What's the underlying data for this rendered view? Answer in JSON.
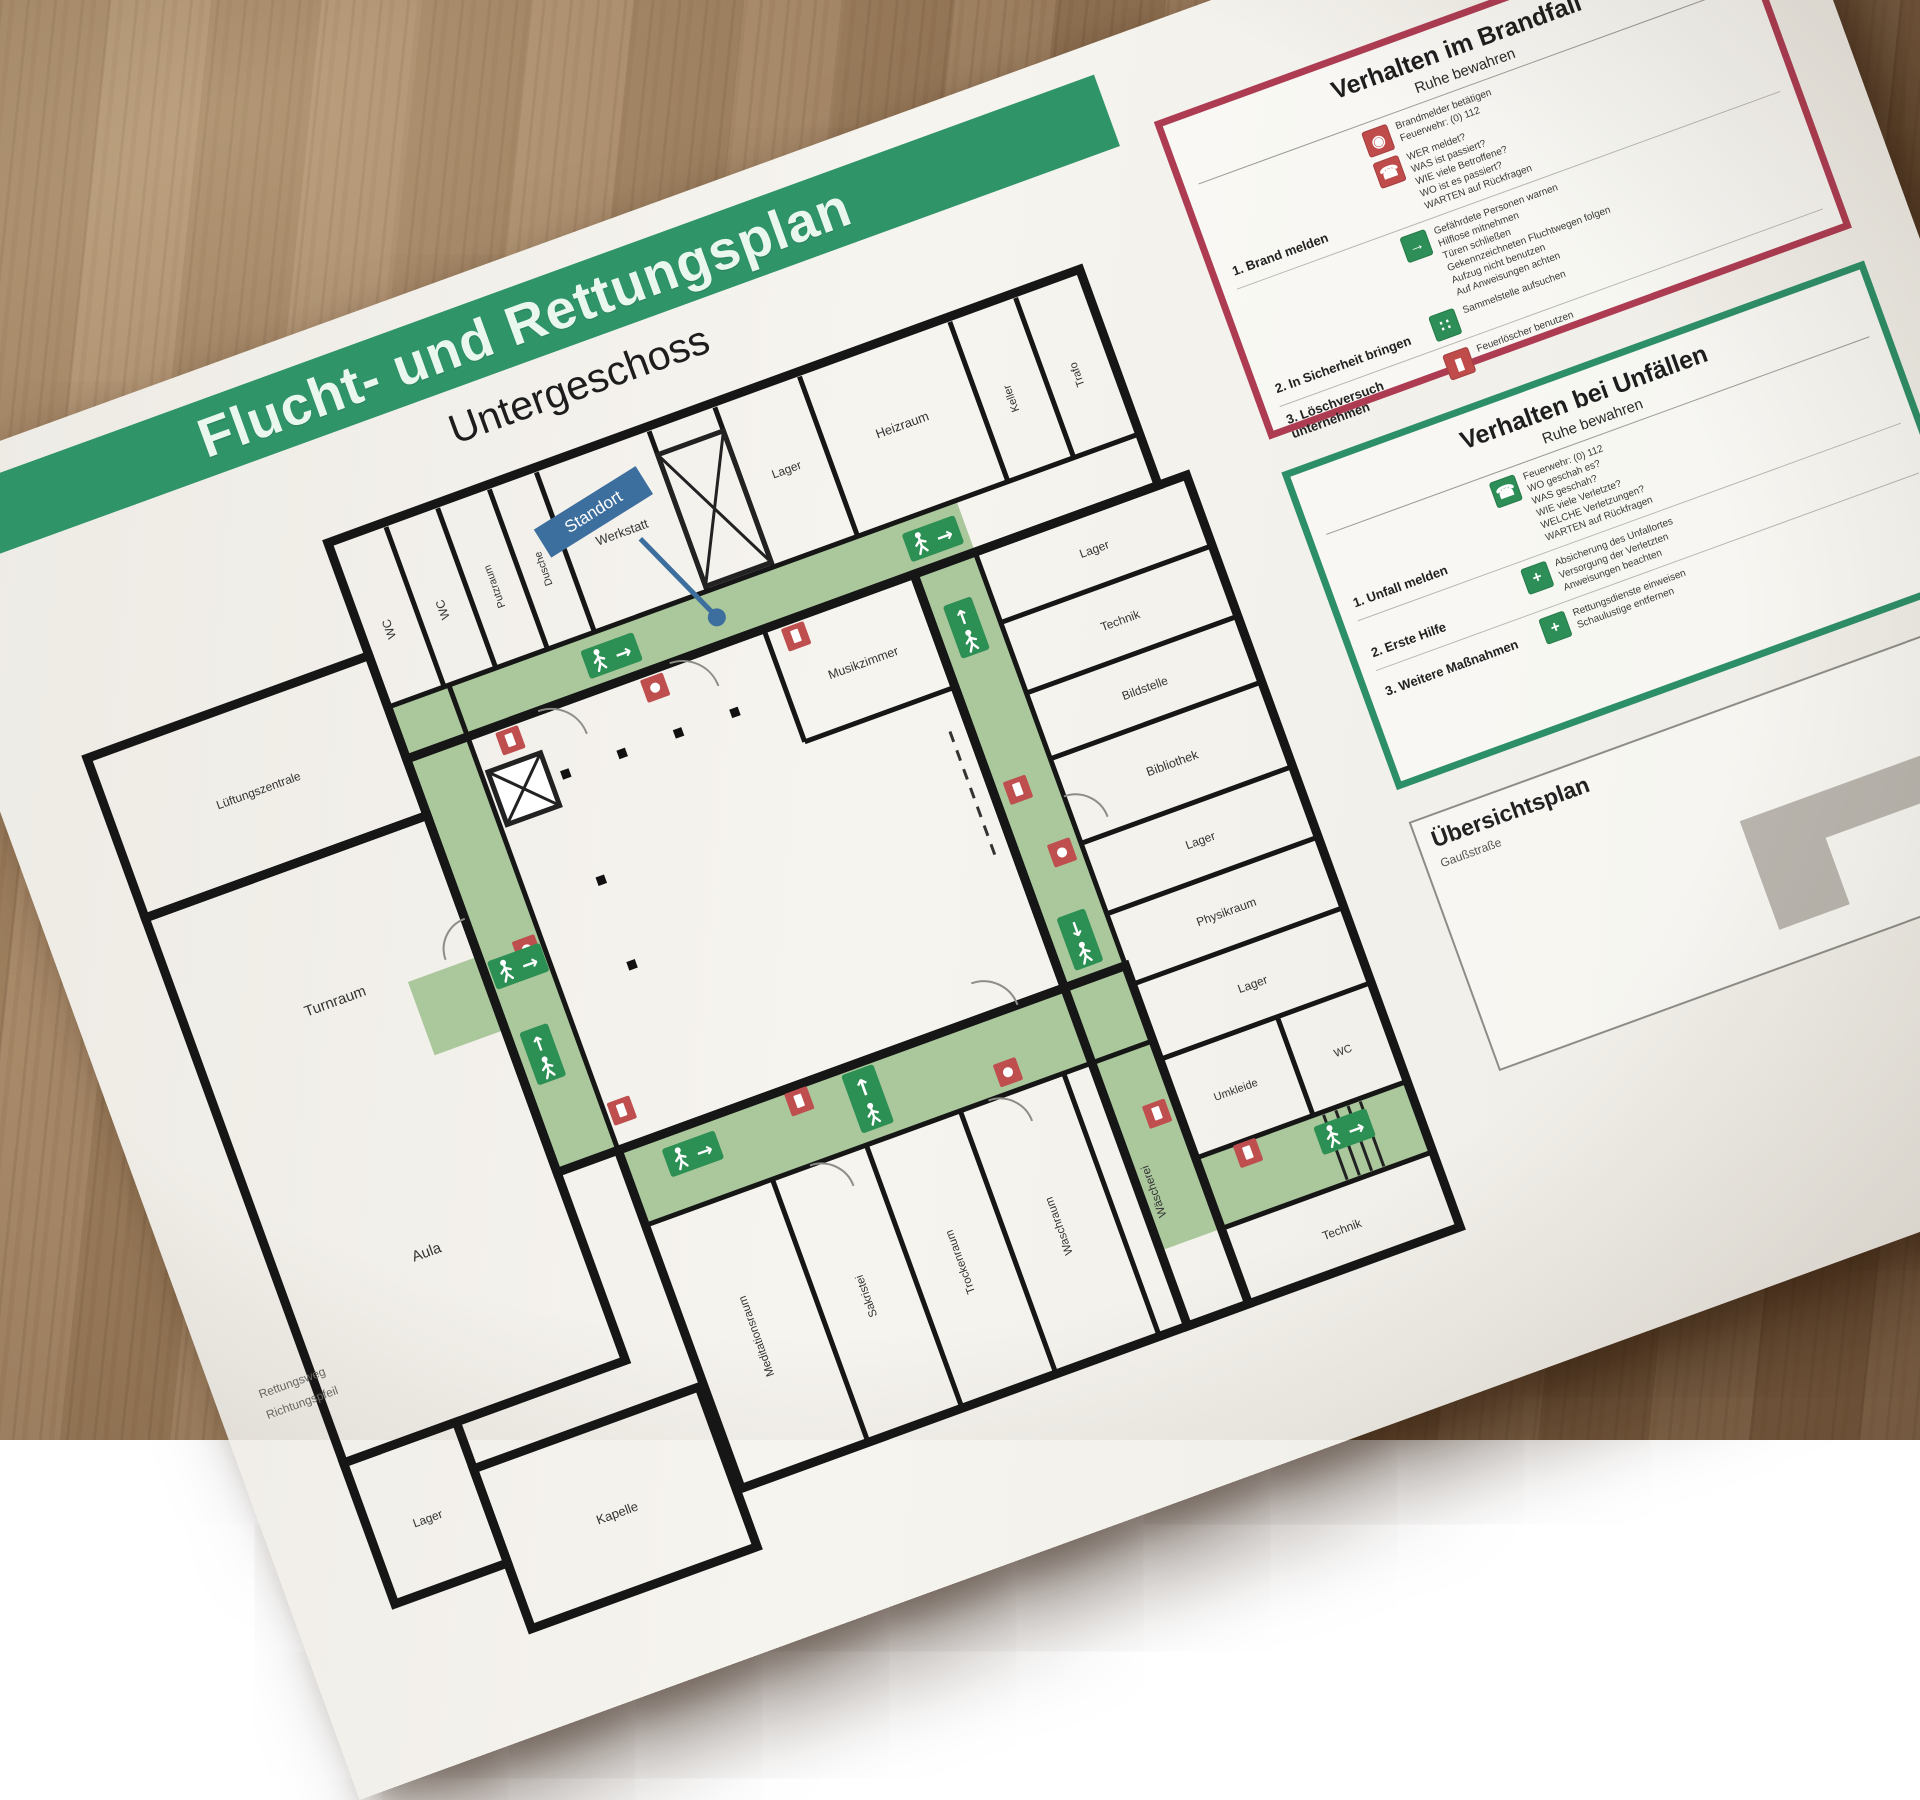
{
  "sheet": {
    "banner_title": "Flucht- und Rettungsplan",
    "floor_label": "Untergeschoss",
    "standort": "Standort",
    "legend_lines": [
      "Rettungsweg",
      "Richtungspfeil"
    ]
  },
  "fire_panel": {
    "title": "Verhalten im Brandfall",
    "subtitle": "Ruhe bewahren",
    "steps": [
      {
        "label": "1. Brand melden",
        "items": [
          {
            "icon": "fire-alarm",
            "glyph": "◉",
            "text": "Brandmelder betätigen\nFeuerwehr: (0) 112"
          },
          {
            "icon": "emergency-phone",
            "glyph": "☎",
            "text": "WER meldet?\nWAS ist passiert?\nWIE viele Betroffene?\nWO ist es passiert?\nWARTEN auf Rückfragen"
          }
        ]
      },
      {
        "label": "2. In Sicherheit bringen",
        "items": [
          {
            "icon": "escape-route",
            "glyph": "→",
            "text": "Gefährdete Personen warnen\nHilflose mitnehmen\nTüren schließen\nGekennzeichneten Fluchtwegen folgen\nAufzug nicht benutzen\nAuf Anweisungen achten"
          },
          {
            "icon": "assembly-point",
            "glyph": "∷",
            "text": "Sammelstelle aufsuchen"
          }
        ]
      },
      {
        "label": "3. Löschversuch unternehmen",
        "items": [
          {
            "icon": "fire-extinguisher",
            "glyph": "▮",
            "text": "Feuerlöscher benutzen"
          }
        ]
      }
    ]
  },
  "accident_panel": {
    "title": "Verhalten bei Unfällen",
    "subtitle": "Ruhe bewahren",
    "steps": [
      {
        "label": "1. Unfall melden",
        "items": [
          {
            "icon": "emergency-phone",
            "glyph": "☎",
            "text": "Feuerwehr: (0) 112\nWO geschah es?\nWAS geschah?\nWIE viele Verletzte?\nWELCHE Verletzungen?\nWARTEN auf Rückfragen"
          }
        ]
      },
      {
        "label": "2. Erste Hilfe",
        "items": [
          {
            "icon": "first-aid",
            "glyph": "+",
            "text": "Absicherung des Unfallortes\nVersorgung der Verletzten\nAnweisungen beachten"
          }
        ]
      },
      {
        "label": "3. Weitere Maßnahmen",
        "items": [
          {
            "icon": "rescue",
            "glyph": "+",
            "text": "Rettungsdienste einweisen\nSchaulustige entfernen"
          }
        ]
      }
    ]
  },
  "overview_panel": {
    "title": "Übersichtsplan",
    "street": "Gaußstraße",
    "assembly_glyph": "∷"
  },
  "plan": {
    "icons": {
      "arrow_right": "→",
      "arrow_up": "↑",
      "arrow_left": "←",
      "arrow_down": "↓"
    },
    "rooms": [
      "Lüftungszentrale",
      "Turnraum",
      "Aula",
      "Lager",
      "Kapelle",
      "WC",
      "WC",
      "Putzraum",
      "Dusche",
      "Werkstatt",
      "Lager",
      "Heizraum",
      "Keller",
      "Trafo",
      "Musikzimmer",
      "Lager",
      "Technik",
      "Bildstelle",
      "Bibliothek",
      "Lager",
      "Physikraum",
      "Lager",
      "Umkleide",
      "WC",
      "Technik",
      "Meditationsraum",
      "Sakristei",
      "Trockenraum",
      "Waschraum",
      "Wäscherei"
    ],
    "colors": {
      "corridor": "#abc79c",
      "exit_green": "#2c8f53",
      "alarm_red": "#bf4f4f",
      "banner_green": "#2f9468",
      "standort_blue": "#3c6e9e"
    }
  }
}
